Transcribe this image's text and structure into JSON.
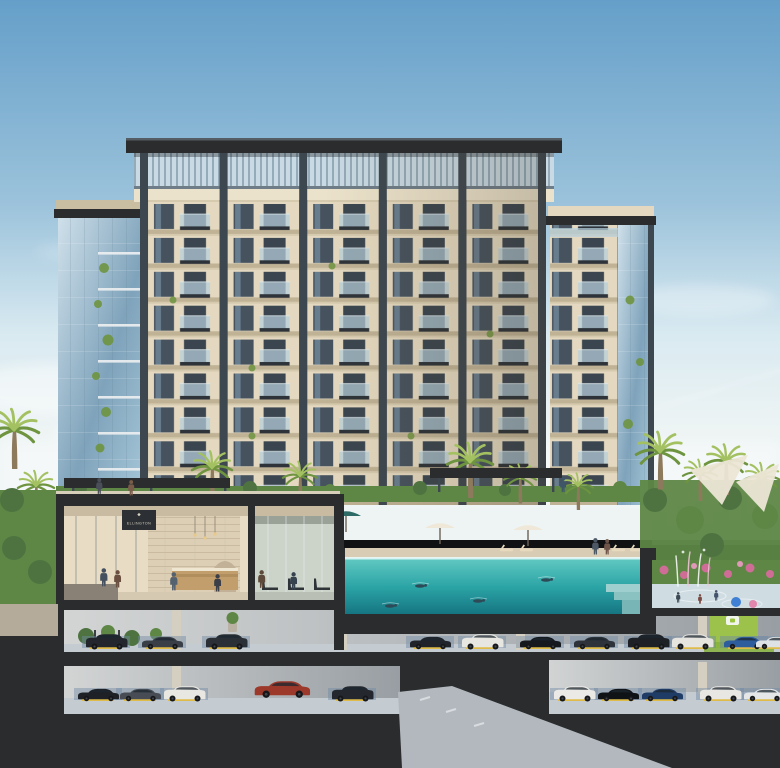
{
  "scene": {
    "description": "Daylight architectural cross-section rendering of a beige mid-rise residential tower with a slatted pergola crown, glass corner wings, landscaped amenity deck with palms, lobby with brand sign, gym, infinity pool shown in section, kids splash pad, and two underground parking levels with cars",
    "signage": {
      "brand": "ELLINGTON",
      "logo_icon": "diamond-icon"
    },
    "building": {
      "floor_rows": 9,
      "facade_bays": 5,
      "parking_levels": 2
    },
    "colors": {
      "sky_top": "#659fc9",
      "sky_mid": "#9cc3db",
      "sky_low": "#d9eaf1",
      "horizon_haze": "#eef4f4",
      "roof_slab": "#33383d",
      "crown_glass": "#c9dae4",
      "crown_slat": "#7d95a4",
      "column_dark": "#3d4750",
      "facade_light": "#e4d9c0",
      "facade_shadow": "#c9bda2",
      "cornice": "#ebe2cb",
      "window_glass": "#46525e",
      "window_reflect": "#8aa8be",
      "balcony_slab": "#2d3339",
      "rail_glass": "#b7d0dd",
      "tower_glass_hi": "#cfe0ea",
      "tower_glass_lo": "#7fa3bb",
      "cut_charcoal": "#2a2c2d",
      "lobby_wall": "#e8dcc4",
      "stone_wall": "#dccfb6",
      "wood_desk": "#c29e6c",
      "gym_wall": "#ccd3c9",
      "pool_shallow": "#62c9c2",
      "pool_deep": "#14727f",
      "deck_stone": "#d9ccb4",
      "palm_trunk": "#8d7a5c",
      "palm_light": "#a4c162",
      "palm_dark": "#6e9440",
      "hedge_green": "#5e8746",
      "flower_pink": "#cf6d97",
      "splash_floor": "#cfdde3",
      "parking_wall": "#c6c9cb",
      "parking_floor": "#c4cbd1",
      "stall_blue": "#7089a4",
      "curb_yellow": "#dfbc4a",
      "ev_green": "#9cc63f",
      "car_red": "#9c392a",
      "sign_panel": "#2c3034",
      "sign_text": "#d8d2c4",
      "skyline": "#b9c9d3"
    },
    "landscape": {
      "palms": [
        {
          "x": 14,
          "y": 430,
          "s": 1.3
        },
        {
          "x": 36,
          "y": 486,
          "s": 0.95
        },
        {
          "x": 212,
          "y": 468,
          "s": 1.05
        },
        {
          "x": 300,
          "y": 476,
          "s": 0.9
        },
        {
          "x": 470,
          "y": 462,
          "s": 1.2
        },
        {
          "x": 520,
          "y": 478,
          "s": 0.85
        },
        {
          "x": 578,
          "y": 486,
          "s": 0.8
        },
        {
          "x": 660,
          "y": 452,
          "s": 1.25
        },
        {
          "x": 700,
          "y": 474,
          "s": 0.9
        },
        {
          "x": 726,
          "y": 462,
          "s": 1.1
        },
        {
          "x": 762,
          "y": 478,
          "s": 0.95
        }
      ],
      "umbrellas": [
        {
          "x": 268,
          "y": 500,
          "c": "#efe8d8"
        },
        {
          "x": 296,
          "y": 504,
          "c": "#efe8d8"
        },
        {
          "x": 346,
          "y": 516,
          "c": "#2e6b66"
        },
        {
          "x": 440,
          "y": 528,
          "c": "#efe8d8"
        },
        {
          "x": 528,
          "y": 530,
          "c": "#efe8d8"
        }
      ],
      "shade_sails": [
        {
          "points": "690,470 748,455 722,505"
        },
        {
          "points": "736,482 779,464 764,512"
        }
      ]
    },
    "people": [
      {
        "x": 96,
        "y": 478,
        "s": 0.82,
        "c": "#4a4e58"
      },
      {
        "x": 128,
        "y": 480,
        "s": 0.8,
        "c": "#7a5c4a"
      },
      {
        "x": 560,
        "y": 477,
        "s": 0.78,
        "c": "#3f5668"
      },
      {
        "x": 100,
        "y": 568,
        "s": 0.95,
        "c": "#44505e"
      },
      {
        "x": 114,
        "y": 570,
        "s": 0.9,
        "c": "#6b4f41"
      },
      {
        "x": 170,
        "y": 572,
        "s": 0.95,
        "c": "#54616f"
      },
      {
        "x": 214,
        "y": 574,
        "s": 0.9,
        "c": "#3c3f47"
      },
      {
        "x": 258,
        "y": 570,
        "s": 0.92,
        "c": "#5d4a3c"
      },
      {
        "x": 290,
        "y": 572,
        "s": 0.9,
        "c": "#37434f"
      },
      {
        "x": 592,
        "y": 538,
        "s": 0.85,
        "c": "#4c5866"
      },
      {
        "x": 604,
        "y": 539,
        "s": 0.8,
        "c": "#70564a"
      },
      {
        "x": 676,
        "y": 592,
        "s": 0.55,
        "c": "#3d4a56"
      },
      {
        "x": 698,
        "y": 594,
        "s": 0.5,
        "c": "#7a4a42"
      },
      {
        "x": 714,
        "y": 590,
        "s": 0.55,
        "c": "#44536b"
      }
    ],
    "pool": {
      "swimmers": [
        {
          "x": 420,
          "y": 586
        },
        {
          "x": 478,
          "y": 601
        },
        {
          "x": 546,
          "y": 580
        },
        {
          "x": 390,
          "y": 606
        }
      ]
    },
    "parking": {
      "level1": {
        "floor_y": 648,
        "cars": [
          {
            "x": 84,
            "t": "suv",
            "c": "#23272d"
          },
          {
            "x": 140,
            "t": "sedan",
            "c": "#3a3f47"
          },
          {
            "x": 204,
            "t": "suv",
            "c": "#2b3036"
          },
          {
            "x": 408,
            "t": "sedan",
            "c": "#20242a"
          },
          {
            "x": 460,
            "t": "suv",
            "c": "#e8e6e1"
          },
          {
            "x": 518,
            "t": "sedan",
            "c": "#15181c"
          },
          {
            "x": 572,
            "t": "sedan",
            "c": "#2e333b"
          },
          {
            "x": 626,
            "t": "suv",
            "c": "#1d2126"
          },
          {
            "x": 670,
            "t": "suv",
            "c": "#e6e4df"
          },
          {
            "x": 722,
            "t": "sedan",
            "c": "#2e5d9e"
          },
          {
            "x": 754,
            "t": "sedan",
            "c": "#dfe2e4"
          }
        ]
      },
      "level2": {
        "floor_y": 700,
        "cars": [
          {
            "x": 76,
            "t": "sedan",
            "c": "#1e2126"
          },
          {
            "x": 118,
            "t": "sedan",
            "c": "#484d55"
          },
          {
            "x": 162,
            "t": "suv",
            "c": "#e9e7e2"
          },
          {
            "x": 330,
            "t": "suv",
            "c": "#24282e"
          },
          {
            "x": 552,
            "t": "suv",
            "c": "#eceae6"
          },
          {
            "x": 596,
            "t": "sedan",
            "c": "#101316"
          },
          {
            "x": 640,
            "t": "sedan",
            "c": "#1f3c66"
          },
          {
            "x": 698,
            "t": "suv",
            "c": "#e9e7e3"
          },
          {
            "x": 742,
            "t": "sedan",
            "c": "#e4e6e8"
          }
        ]
      },
      "feature_car": {
        "x": 252,
        "y": 678,
        "s": 1.35,
        "c": "#9c392a",
        "t": "sedan"
      }
    }
  }
}
